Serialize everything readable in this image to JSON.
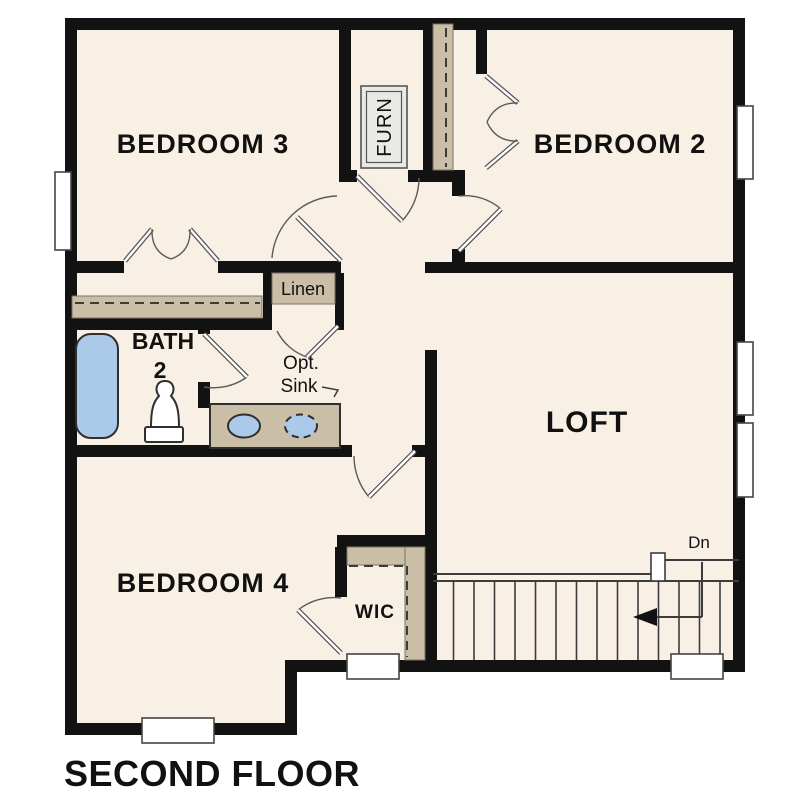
{
  "title": "SECOND FLOOR",
  "colors": {
    "floor": "#f8f0e4",
    "wall": "#121212",
    "cabinet": "#cabea6",
    "cabinet_edge": "#7a7264",
    "water_fixture": "#abc9e9",
    "fixture_edge": "#2f2f2f",
    "furnace_fill": "#e9e9e5",
    "line": "#3c3c3c",
    "window": "#ffffff",
    "label": "#111111"
  },
  "rooms": {
    "bedroom3": {
      "label": "BEDROOM 3"
    },
    "bedroom2": {
      "label": "BEDROOM 2"
    },
    "bedroom4": {
      "label": "BEDROOM 4"
    },
    "loft": {
      "label": "LOFT"
    },
    "bath2": {
      "label_line1": "BATH",
      "label_line2": "2"
    },
    "wic": {
      "label": "WIC"
    },
    "furnace": {
      "label": "FURN"
    },
    "linen": {
      "label": "Linen"
    }
  },
  "annotations": {
    "opt_sink": {
      "line1": "Opt.",
      "line2": "Sink"
    },
    "stairs_down": {
      "label": "Dn",
      "direction": "down",
      "tread_count": 14
    }
  },
  "fixtures": [
    "bathtub",
    "toilet",
    "vanity-with-sink",
    "optional-second-sink",
    "furnace",
    "stairs",
    "linen-closet",
    "walk-in-closet",
    "bedroom-closets"
  ],
  "windows": {
    "count": 7
  }
}
